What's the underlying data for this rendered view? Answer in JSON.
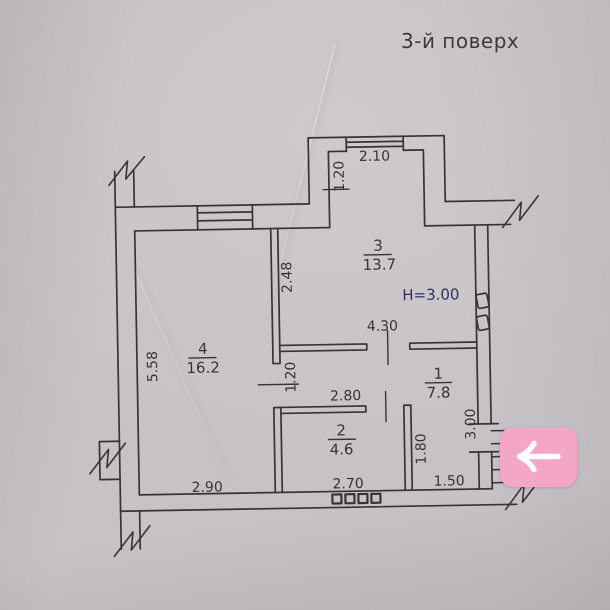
{
  "page": {
    "floor_label": "3-й поверх"
  },
  "plan": {
    "height_note": "H=3.00",
    "rooms": [
      {
        "number": "1",
        "area": "7.8"
      },
      {
        "number": "2",
        "area": "4.6"
      },
      {
        "number": "3",
        "area": "13.7"
      },
      {
        "number": "4",
        "area": "16.2"
      }
    ],
    "dims": {
      "balcony_width": "2.10",
      "balcony_depth": "1.20",
      "room3_left": "2.48",
      "hall_top": "4.30",
      "room4_left": "5.58",
      "room4_door": "1.20",
      "room2_top": "2.80",
      "room2_right": "1.80",
      "entry_side": "3.00",
      "bottom_left": "2.90",
      "bottom_mid": "2.70",
      "bottom_right": "1.50"
    },
    "colors": {
      "ink": "#3a3336",
      "paper": "#c7c2c6",
      "height_note": "#32325c"
    }
  },
  "controls": {
    "back_button": {
      "icon": "arrow-left",
      "color": "#f3a6c6"
    }
  }
}
